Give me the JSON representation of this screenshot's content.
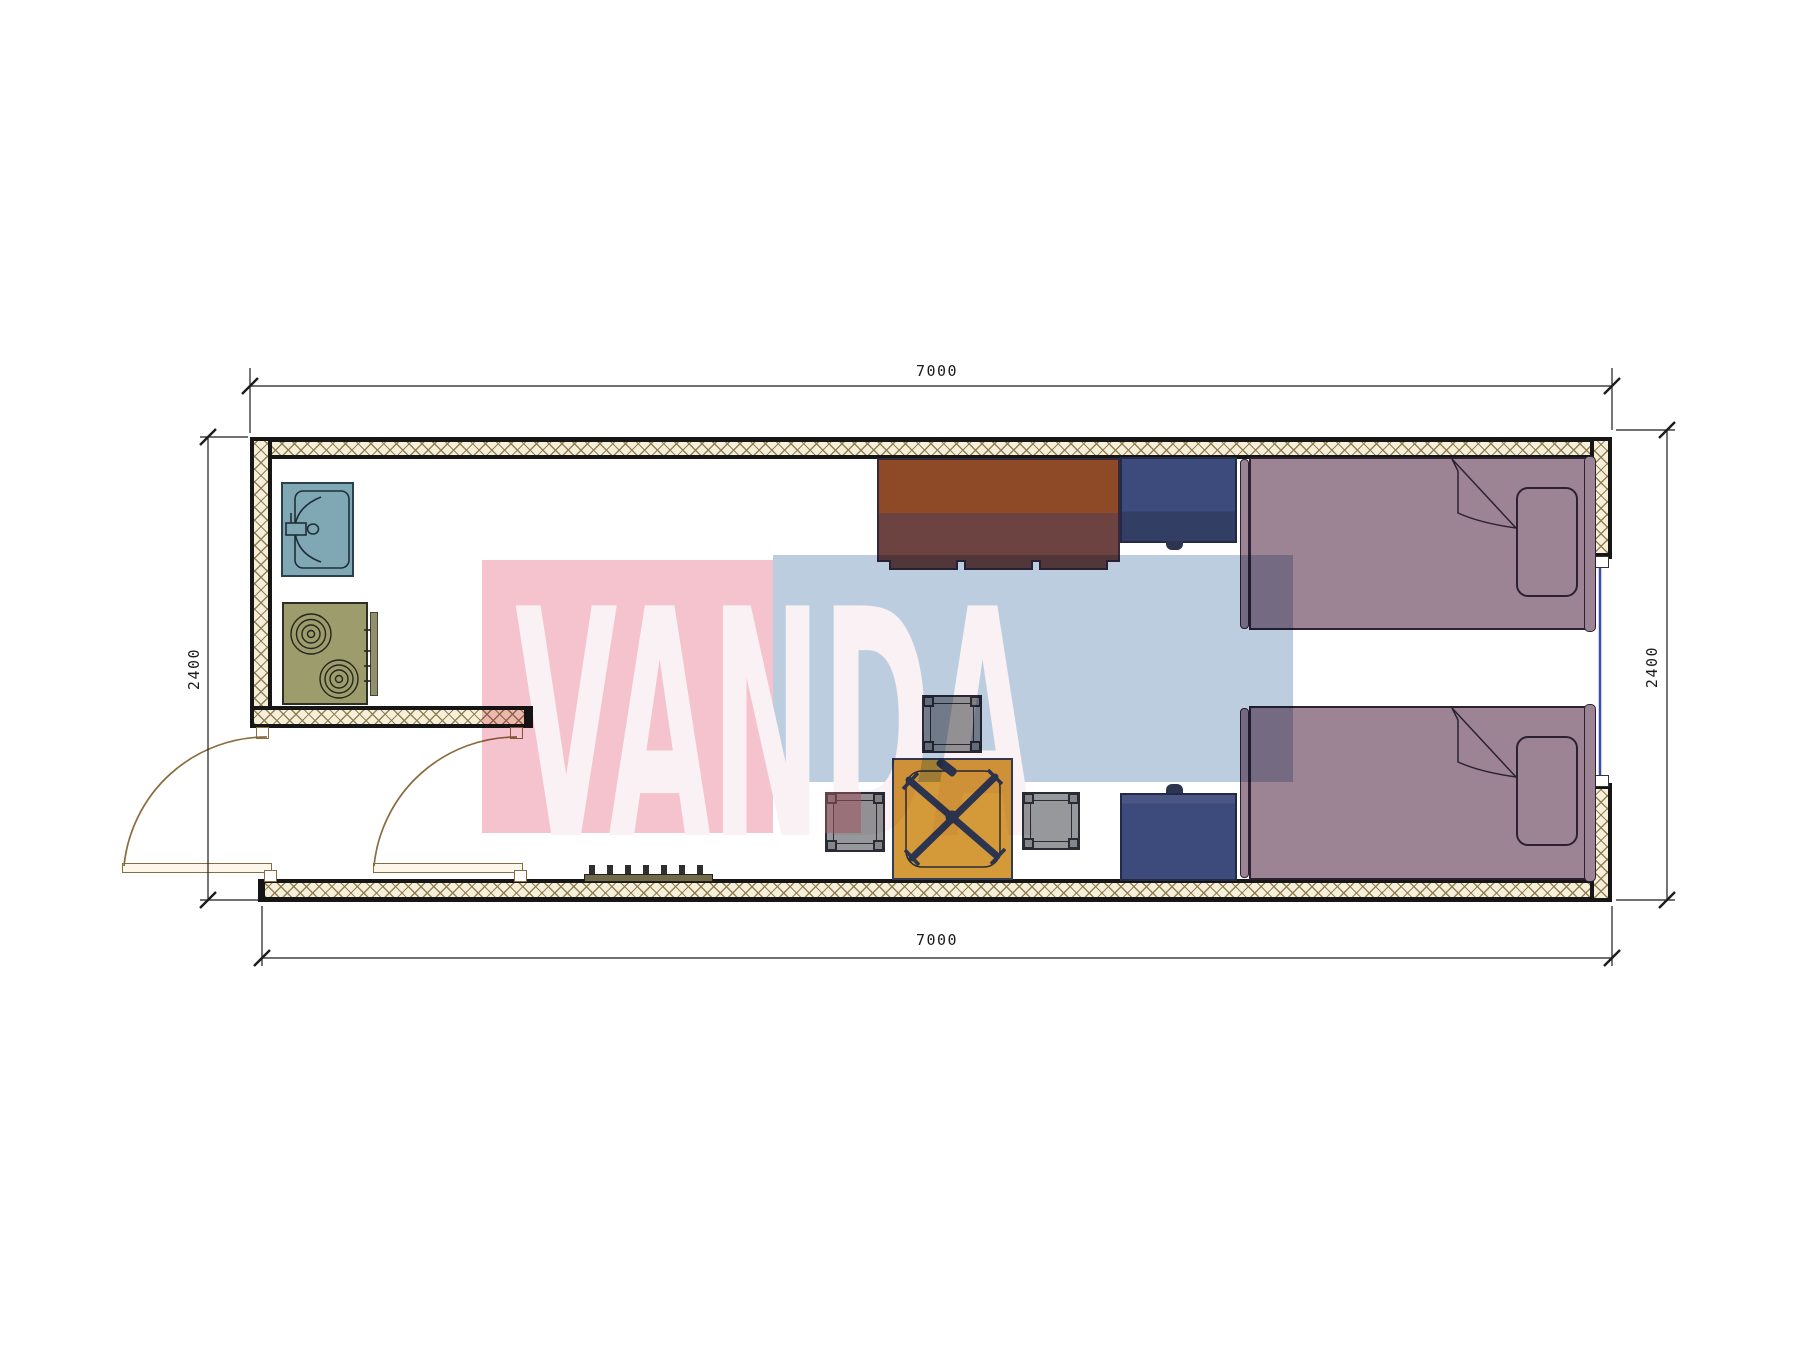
{
  "title": "floor-plan-drawing",
  "dimensions": {
    "top": "7000",
    "bottom": "7000",
    "left": "2400",
    "right": "2400",
    "units": "mm"
  },
  "watermark": {
    "text": "VANDA",
    "pink_box_color": "#F5C3CD",
    "blue_box_color": "#BDCDE0",
    "text_color": "#F9F1F3"
  },
  "palette": {
    "wall_hatch_line": "#8D7B4E",
    "wall_hatch_bg": "#F6EFDA",
    "wall_outline": "#161616",
    "sink": "#7FA8B4",
    "stove": "#9C9C6D",
    "desk_top": "#8E4A27",
    "desk_front": "#6D4342",
    "nightstand": "#3D4B7C",
    "bed": "#9C8494",
    "table": "#D49939",
    "chair_frame": "#2C3550",
    "stool": "#97989B",
    "door": "#FCF7EA",
    "door_arc": "#8A6D3F",
    "window_glass": "#3B4CB1",
    "rack": "#716A4A"
  },
  "rooms": {
    "kitchen_items": [
      "sink",
      "stove",
      "partition-wall"
    ],
    "living_items": [
      "desk",
      "nightstand",
      "bed",
      "pillow",
      "stool",
      "table-with-chair",
      "shoe-rack"
    ],
    "openings": [
      "entry-door-left",
      "entry-door-right",
      "window-right"
    ]
  }
}
